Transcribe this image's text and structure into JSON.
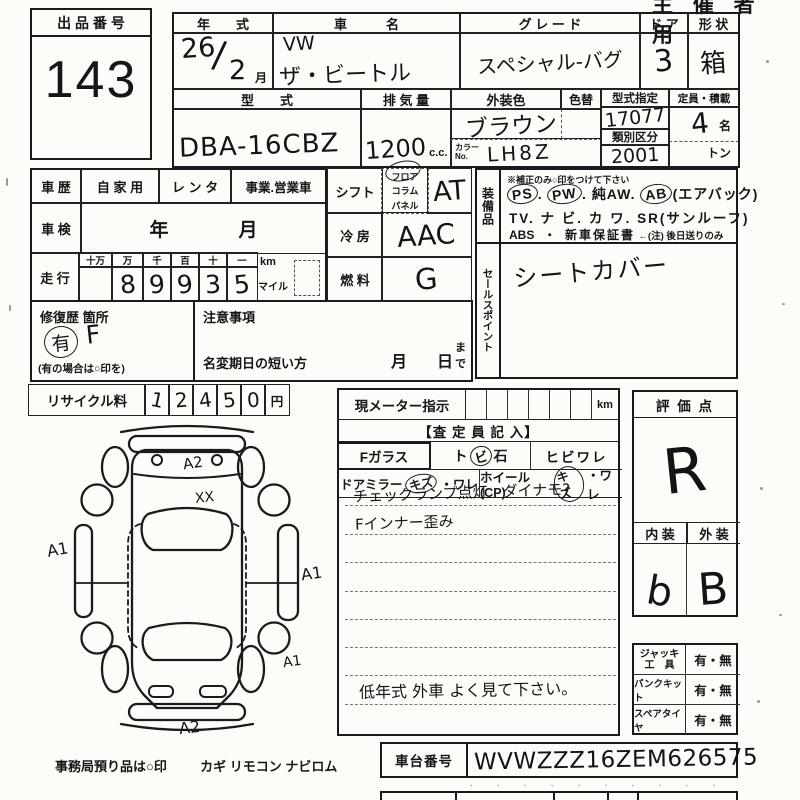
{
  "corner": {
    "copy": "主 催 者 用"
  },
  "lot": {
    "header": "出 品 番 号",
    "number": "143"
  },
  "top": {
    "year_h": "年　　式",
    "year_a": "26",
    "year_slash": "/",
    "year_b": "2",
    "year_unit": "月",
    "name_h": "車　　　名",
    "name1": "VW",
    "name2": "ザ・ビートル",
    "grade_h": "グ レ ー ド",
    "grade": "スペシャル-バグ",
    "door_h": "ド ア",
    "door": "3",
    "shape_h": "形 状",
    "shape": "箱",
    "model_h": "型　　式",
    "model": "DBA-16CBZ",
    "disp_h": "排 気 量",
    "disp": "1200",
    "disp_u": "c.c.",
    "color_h": "外装色",
    "color": "ブラウン",
    "colorno_l1": "カラー",
    "colorno_l2": "No.",
    "colorno": "LH8Z",
    "repaint_h": "色替",
    "typedes_h": "型式指定",
    "typedes": "17077",
    "class_h": "類別区分",
    "class_v": "2001",
    "cap_h": "定員・積載",
    "cap": "4",
    "cap_u": "名",
    "load_u": "トン"
  },
  "hist": {
    "h": "車 歴",
    "o1": "自 家 用",
    "o2": "レ ン タ",
    "o3": "事業.営業車"
  },
  "insp": {
    "h": "車 検",
    "y": "年",
    "m": "月"
  },
  "run": {
    "h": "走 行",
    "c1": "十万",
    "c2": "万",
    "c3": "千",
    "c4": "百",
    "c5": "十",
    "c6": "一",
    "d2": "8",
    "d3": "9",
    "d4": "9",
    "d5": "3",
    "d6": "5",
    "km": "km",
    "mile": "マイル"
  },
  "shift": {
    "h": "シフト",
    "o1": "フロア",
    "o2": "コラム",
    "o3": "パネル",
    "v": "AT"
  },
  "ac": {
    "h": "冷 房",
    "v": "AAC"
  },
  "fuel": {
    "h": "燃 料",
    "v": "G"
  },
  "repair": {
    "h": "修復歴 箇所",
    "circ": "有",
    "mark": "F",
    "note": "(有の場合は○印を)"
  },
  "caution": {
    "h": "注意事項",
    "transfer": "名変期日の短い方",
    "m": "月",
    "d": "日",
    "made": "まで"
  },
  "equip": {
    "vlabel": "装備品",
    "note": "※補正のみ○印をつけて下さい",
    "ps": "PS",
    "pw": "PW",
    "aw": "純AW.",
    "ab": "AB",
    "ab_note": "(エアバック)",
    "dot": ".",
    "tv": "TV.",
    "navi": "ナ ビ.",
    "kawa": "カ ワ.",
    "sr": "SR",
    "sr_note": "(サンルーフ)",
    "abs": "ABS",
    "sep": "・",
    "warranty": "新車保証書",
    "warranty_note": "←(注) 後日送りのみ"
  },
  "sales": {
    "vlabel": "セールスポイント",
    "v": "シートカバー"
  },
  "recycle": {
    "h": "リサイクル料",
    "d1": "1",
    "d2": "2",
    "d3": "4",
    "d4": "5",
    "d5": "0",
    "u": "円"
  },
  "meter": {
    "h": "現メーター指示",
    "u": "km"
  },
  "assess": {
    "h": "【査 定 員 記 入】",
    "fg": "Fガラス",
    "fg_a": "ト",
    "fg_b": "ビ",
    "fg_c": "石",
    "fg_d": "ヒビワレ",
    "dm": "ドアミラー",
    "dm_a": "キズ",
    "dm_b": "・ワレ",
    "wh": "ホイール(CP)",
    "wh_a": "キズ",
    "wh_b": "・ワレ",
    "note1": "チェックランプ点灯　ダイナモ?",
    "note2": "Fインナー歪み",
    "note3": "低年式  外車 よく見て下さい。"
  },
  "score": {
    "h": "評 価 点",
    "v": "R",
    "in_h": "内 装",
    "out_h": "外 装",
    "in_v": "b",
    "out_v": "B"
  },
  "acc": {
    "l1a": "ジャッキ",
    "l1b": "工　具",
    "v1": "有・無",
    "l2": "パンクキット",
    "v2": "有・無",
    "l3": "スペアタイヤ",
    "v3": "有・無"
  },
  "vin": {
    "h": "車台番号",
    "v": "WVWZZZ16ZEM626575"
  },
  "footer": {
    "office": "事務局預り品は○印",
    "items": "カギ  リモコン  ナビロム",
    "ticks": "、 、 、  、 、 、  、 、 、 、"
  },
  "marks": {
    "front": "A2",
    "glass": "XX",
    "left": "A1",
    "right": "A1",
    "rrear": "A1",
    "rear": "A2"
  }
}
